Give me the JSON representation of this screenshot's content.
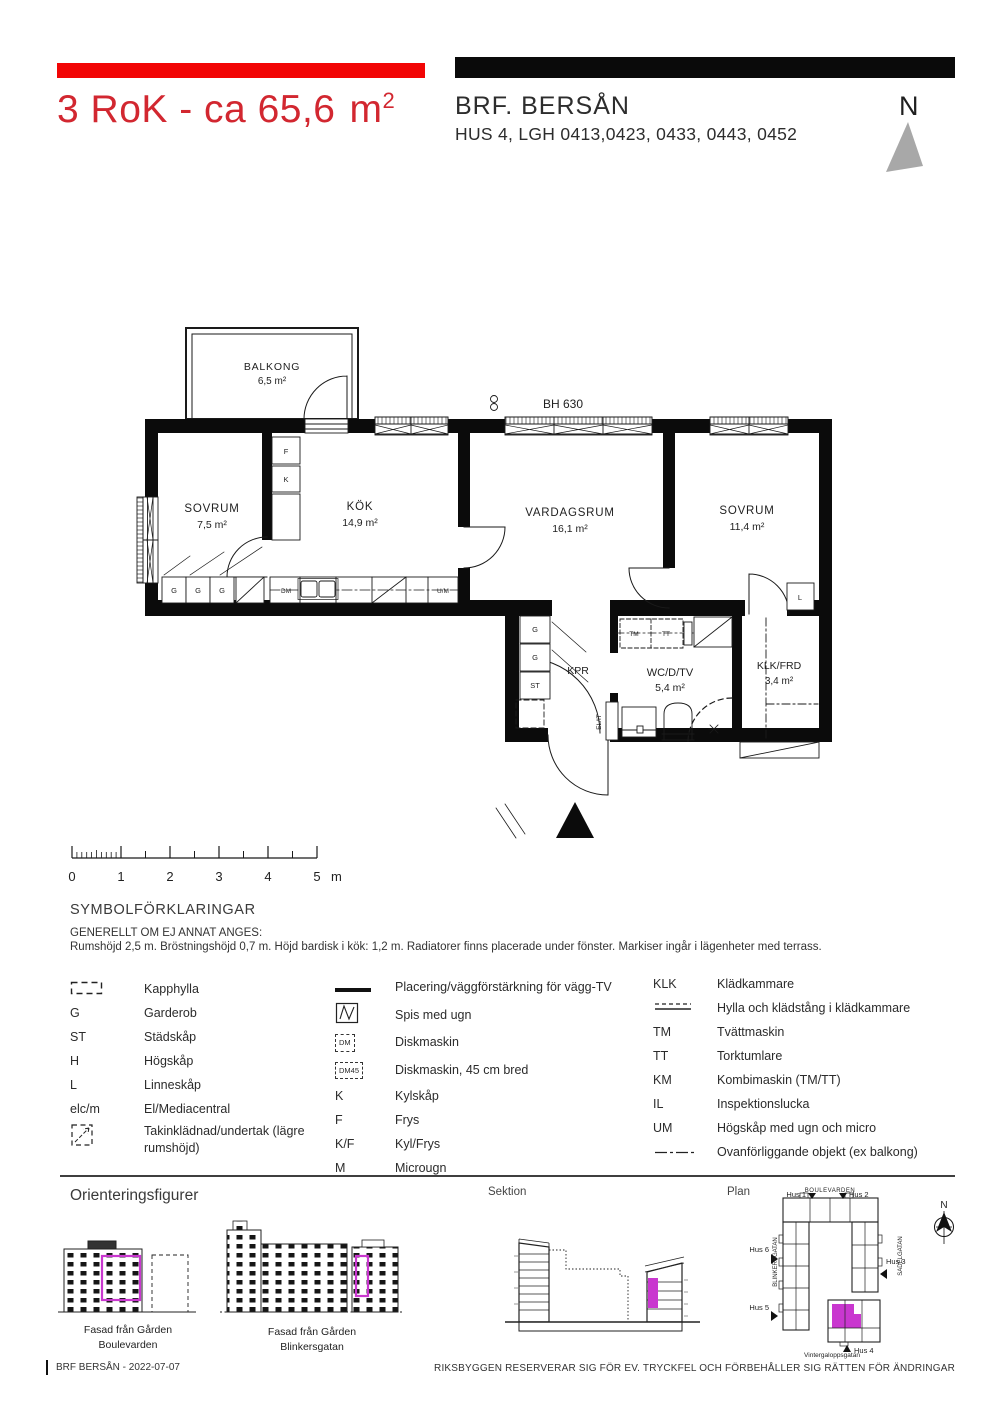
{
  "header": {
    "title_main": "3 RoK - ca 65,6",
    "title_unit": "m",
    "title_sup": "2",
    "project": "BRF. BERSÅN",
    "subtitle": "HUS 4, LGH 0413,0423, 0433, 0443, 0452",
    "north_label": "N"
  },
  "floorplan": {
    "bh_label": "BH 630",
    "rooms": {
      "balkong": {
        "name": "BALKONG",
        "area": "6,5 m²"
      },
      "sovrum1": {
        "name": "SOVRUM",
        "area": "7,5 m²"
      },
      "kok": {
        "name": "KÖK",
        "area": "14,9 m²"
      },
      "vardagsrum": {
        "name": "VARDAGSRUM",
        "area": "16,1 m²"
      },
      "sovrum2": {
        "name": "SOVRUM",
        "area": "11,4 m²"
      },
      "wc": {
        "name": "WC/D/TV",
        "area": "5,4 m²"
      },
      "klk": {
        "name": "KLK/FRD",
        "area": "3,4 m²"
      },
      "kpr": {
        "name": "KPR"
      }
    },
    "fx": {
      "f": "F",
      "k": "K",
      "g": "G",
      "st": "ST",
      "l": "L",
      "dm": "DM",
      "um": "U/M",
      "tm": "TM",
      "tt": "TT",
      "elit": "EL/IT"
    }
  },
  "scalebar": {
    "ticks": [
      "0",
      "1",
      "2",
      "3",
      "4",
      "5"
    ],
    "unit": "m"
  },
  "symbols_section": {
    "heading": "SYMBOLFÖRKLARINGAR",
    "note1": "GENERELLT OM EJ ANNAT ANGES:",
    "note2": "Rumshöjd 2,5 m. Bröstningshöjd 0,7 m. Höjd bardisk i kök: 1,2 m. Radiatorer finns placerade under fönster. Markiser ingår i lägenheter med terrass."
  },
  "legend": {
    "col1": [
      {
        "sym": "",
        "label": "Kapphylla"
      },
      {
        "sym": "G",
        "label": "Garderob"
      },
      {
        "sym": "ST",
        "label": "Städskåp"
      },
      {
        "sym": "H",
        "label": "Högskåp"
      },
      {
        "sym": "L",
        "label": "Linneskåp"
      },
      {
        "sym": "elc/m",
        "label": "El/Mediacentral"
      },
      {
        "sym": "",
        "label": "Takinklädnad/undertak (lägre rumshöjd)"
      }
    ],
    "col2": [
      {
        "sym": "",
        "label": "Placering/väggförstärkning för vägg-TV"
      },
      {
        "sym": "",
        "label": "Spis med ugn"
      },
      {
        "sym": "DM",
        "label": "Diskmaskin"
      },
      {
        "sym": "DM45",
        "label": "Diskmaskin, 45 cm bred"
      },
      {
        "sym": "K",
        "label": "Kylskåp"
      },
      {
        "sym": "F",
        "label": "Frys"
      },
      {
        "sym": "K/F",
        "label": "Kyl/Frys"
      },
      {
        "sym": "M",
        "label": "Microugn"
      }
    ],
    "col3": [
      {
        "sym": "KLK",
        "label": "Klädkammare"
      },
      {
        "sym": "",
        "label": "Hylla och klädstång i klädkammare"
      },
      {
        "sym": "TM",
        "label": "Tvättmaskin"
      },
      {
        "sym": "TT",
        "label": "Torktumlare"
      },
      {
        "sym": "KM",
        "label": "Kombimaskin (TM/TT)"
      },
      {
        "sym": "IL",
        "label": "Inspektionslucka"
      },
      {
        "sym": "UM",
        "label": "Högskåp med ugn och micro"
      },
      {
        "sym": "",
        "label": "Ovanförliggande objekt (ex  balkong)"
      }
    ]
  },
  "orientation": {
    "heading": "Orienteringsfigurer",
    "sektion_label": "Sektion",
    "plan_label": "Plan",
    "fasad1_line1": "Fasad från Gården",
    "fasad1_line2": "Boulevarden",
    "fasad2_line1": "Fasad från Gården",
    "fasad2_line2": "Blinkersgatan",
    "plan": {
      "streets": {
        "top": "BOULEVARDEN",
        "left": "BLINKERSGATAN",
        "right": "SADELGATAN",
        "bottom": "Vintergaloppsgatan"
      },
      "houses": [
        "Hus 1",
        "Hus 2",
        "Hus 3",
        "Hus 4",
        "Hus 5",
        "Hus 6"
      ],
      "north_label": "N"
    }
  },
  "footer": {
    "left": "BRF BERSÅN - 2022-07-07",
    "right": "RIKSBYGGEN RESERVERAR SIG FÖR EV. TRYCKFEL OCH FÖRBEHÅLLER SIG RÄTTEN FÖR ÄNDRINGAR"
  },
  "colors": {
    "accent_red": "#f20505",
    "title_red": "#d22730",
    "highlight_magenta": "#c937cf",
    "wall_black": "#0b0b0b",
    "north_gray": "#a8a8a8"
  }
}
